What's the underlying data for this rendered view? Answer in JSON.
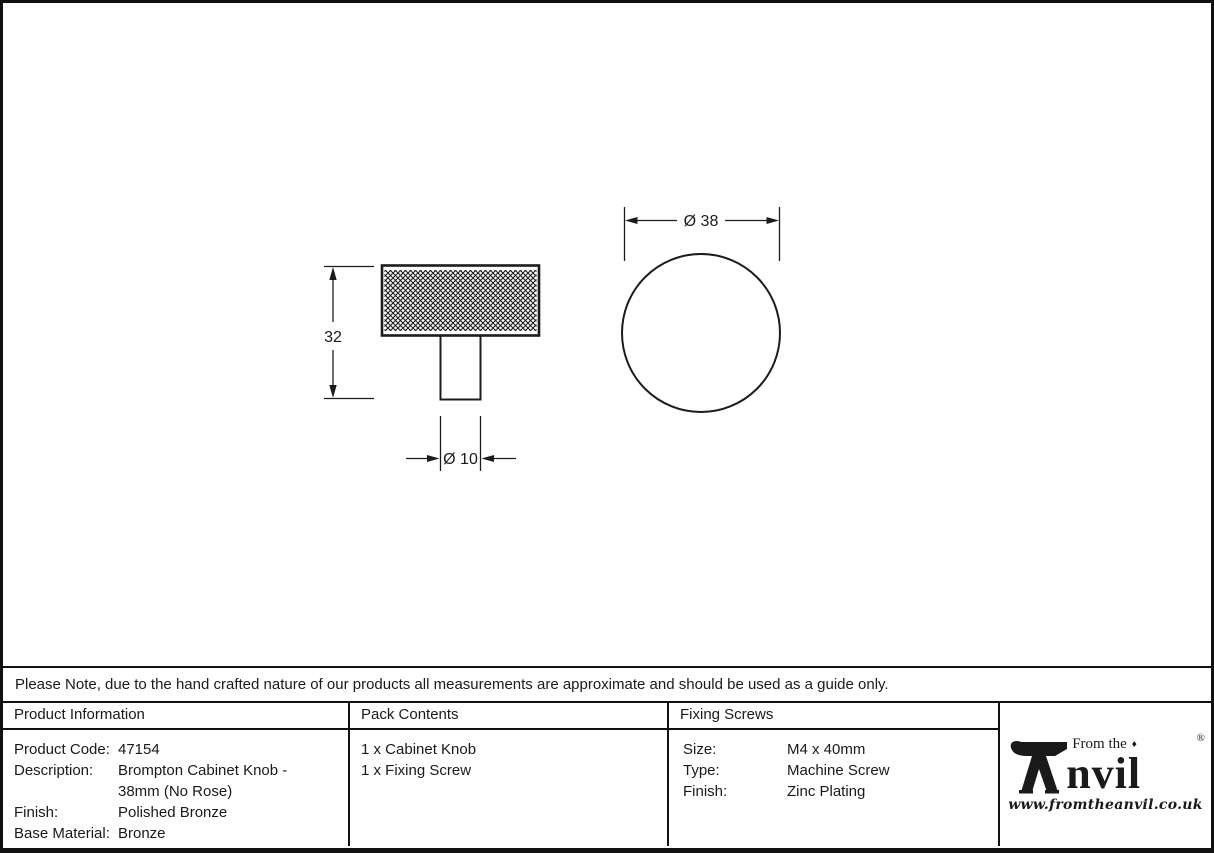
{
  "drawing": {
    "height_label": "32",
    "stem_diameter_label": "Ø 10",
    "knob_diameter_label": "Ø 38"
  },
  "note": "Please Note, due to the hand crafted nature of our products all measurements are approximate and should be used as a guide only.",
  "product_information": {
    "header": "Product Information",
    "rows": [
      {
        "label": "Product Code:",
        "value": "47154"
      },
      {
        "label": "Description:",
        "value": "Brompton Cabinet Knob - 38mm (No Rose)"
      },
      {
        "label": "Finish:",
        "value": "Polished Bronze"
      },
      {
        "label": "Base Material:",
        "value": "Bronze"
      }
    ]
  },
  "pack_contents": {
    "header": "Pack Contents",
    "items": [
      "1 x Cabinet Knob",
      "1 x Fixing Screw"
    ]
  },
  "fixing_screws": {
    "header": "Fixing Screws",
    "rows": [
      {
        "label": "Size:",
        "value": "M4 x 40mm"
      },
      {
        "label": "Type:",
        "value": "Machine Screw"
      },
      {
        "label": "Finish:",
        "value": "Zinc Plating"
      }
    ]
  },
  "logo": {
    "prefix": "From the",
    "diamond": "♦",
    "name_rest": "nvil",
    "registered": "®",
    "website": "www.fromtheanvil.co.uk"
  },
  "colors": {
    "ink": "#1a1a1a",
    "line": "#1c1c1c",
    "background": "#ffffff"
  }
}
